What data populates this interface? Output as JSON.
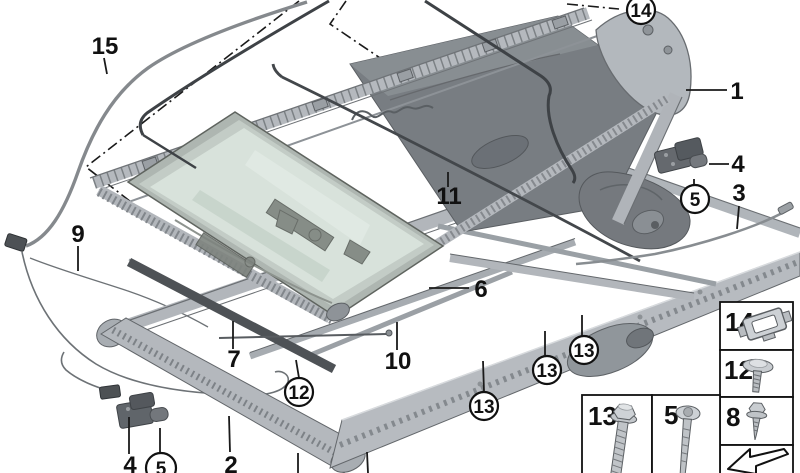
{
  "diagram_type": "exploded-parts-diagram",
  "callouts": [
    {
      "label": "15",
      "shape": "plain"
    },
    {
      "label": "9",
      "shape": "plain"
    },
    {
      "label": "14",
      "shape": "circle"
    },
    {
      "label": "1",
      "shape": "plain"
    },
    {
      "label": "4",
      "shape": "plain"
    },
    {
      "label": "5",
      "shape": "circle"
    },
    {
      "label": "3",
      "shape": "plain"
    },
    {
      "label": "11",
      "shape": "plain"
    },
    {
      "label": "6",
      "shape": "plain"
    },
    {
      "label": "7",
      "shape": "plain"
    },
    {
      "label": "10",
      "shape": "plain"
    },
    {
      "label": "12",
      "shape": "circle"
    },
    {
      "label": "13",
      "shape": "circle"
    },
    {
      "label": "13",
      "shape": "circle"
    },
    {
      "label": "13",
      "shape": "circle"
    },
    {
      "label": "4",
      "shape": "plain"
    },
    {
      "label": "5",
      "shape": "circle"
    },
    {
      "label": "2",
      "shape": "plain"
    }
  ],
  "legend": {
    "boxes": [
      {
        "label": "14",
        "icon": "retaining-clip"
      },
      {
        "label": "12",
        "icon": "flat-head-rivet-screw"
      },
      {
        "label": "8",
        "icon": "self-tapping-screw"
      },
      {
        "label": "13",
        "icon": "hex-flange-bolt"
      },
      {
        "label": "5",
        "icon": "pan-head-screw"
      },
      {
        "label": "",
        "icon": "direction-arrow"
      }
    ]
  },
  "colors": {
    "background": "#ffffff",
    "line": "#111111",
    "metal_light": "#c6cace",
    "metal_mid": "#9aa0a5",
    "metal_dark": "#5c6065",
    "glass": "#d9e3dc",
    "panel": "#787d82",
    "seal": "#3e4246"
  }
}
